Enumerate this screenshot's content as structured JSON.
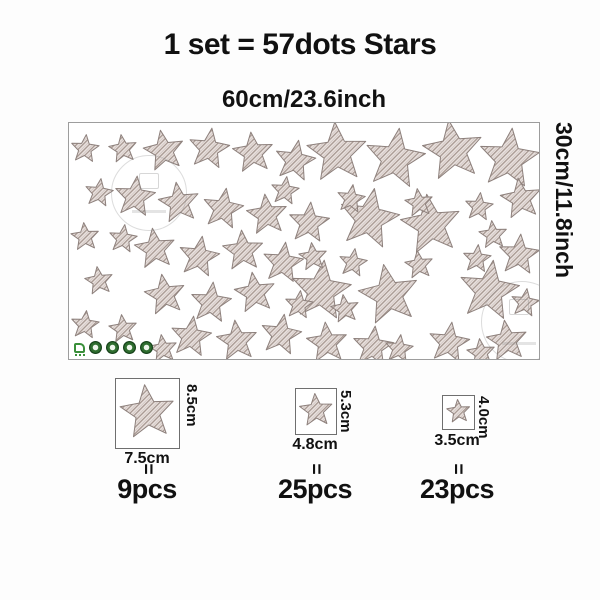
{
  "title": "1 set = 57dots Stars",
  "sheet": {
    "width_label": "60cm/23.6inch",
    "height_label": "30cm/11.8inch"
  },
  "specs": [
    {
      "height_label": "8.5cm",
      "width_label": "7.5cm",
      "equals": "=",
      "count": "9pcs"
    },
    {
      "height_label": "5.3cm",
      "width_label": "4.8cm",
      "equals": "=",
      "count": "25pcs"
    },
    {
      "height_label": "4.0cm",
      "width_label": "3.5cm",
      "equals": "=",
      "count": "23pcs"
    }
  ],
  "star_sizes_px": {
    "large": 62,
    "medium": 42,
    "small": 29
  },
  "spec_star_sizes": {
    "large": 56,
    "medium": 34,
    "small": 24
  },
  "stars": {
    "large": [
      [
        268,
        30,
        -4
      ],
      [
        326,
        36,
        8
      ],
      [
        384,
        28,
        -8
      ],
      [
        440,
        36,
        6
      ],
      [
        300,
        96,
        10
      ],
      [
        362,
        102,
        -8
      ],
      [
        252,
        168,
        6
      ],
      [
        320,
        172,
        -10
      ],
      [
        420,
        168,
        8
      ]
    ],
    "medium": [
      [
        95,
        28,
        -10
      ],
      [
        140,
        26,
        8
      ],
      [
        184,
        30,
        -6
      ],
      [
        226,
        38,
        10
      ],
      [
        66,
        74,
        6
      ],
      [
        110,
        80,
        -8
      ],
      [
        154,
        86,
        9
      ],
      [
        198,
        92,
        -6
      ],
      [
        240,
        100,
        5
      ],
      [
        86,
        126,
        -7
      ],
      [
        130,
        134,
        9
      ],
      [
        174,
        128,
        -4
      ],
      [
        214,
        140,
        7
      ],
      [
        96,
        172,
        -9
      ],
      [
        142,
        180,
        6
      ],
      [
        186,
        170,
        -8
      ],
      [
        122,
        214,
        7
      ],
      [
        168,
        218,
        -6
      ],
      [
        212,
        212,
        9
      ],
      [
        258,
        220,
        -5
      ],
      [
        304,
        224,
        6
      ],
      [
        452,
        76,
        -8
      ],
      [
        450,
        132,
        5
      ],
      [
        380,
        220,
        8
      ],
      [
        438,
        218,
        -7
      ]
    ],
    "small": [
      [
        16,
        26,
        5
      ],
      [
        54,
        26,
        -8
      ],
      [
        30,
        70,
        8
      ],
      [
        16,
        114,
        -5
      ],
      [
        54,
        116,
        7
      ],
      [
        30,
        158,
        -8
      ],
      [
        16,
        202,
        6
      ],
      [
        54,
        206,
        -6
      ],
      [
        282,
        76,
        8
      ],
      [
        350,
        80,
        -7
      ],
      [
        410,
        84,
        6
      ],
      [
        424,
        112,
        -5
      ],
      [
        216,
        68,
        7
      ],
      [
        244,
        134,
        -6
      ],
      [
        284,
        140,
        8
      ],
      [
        350,
        142,
        -7
      ],
      [
        408,
        136,
        5
      ],
      [
        94,
        226,
        -7
      ],
      [
        230,
        182,
        6
      ],
      [
        276,
        186,
        -8
      ],
      [
        330,
        226,
        7
      ],
      [
        412,
        230,
        -6
      ],
      [
        456,
        180,
        8
      ]
    ]
  },
  "colors": {
    "star_fill": "#ece4e1",
    "star_hatch": "#a5968f",
    "star_outline": "#8d807c",
    "cert_green": "#2f6e2f",
    "text": "#111111"
  },
  "cert_icons": [
    "eco-leaf",
    "badge",
    "badge",
    "badge",
    "badge"
  ]
}
